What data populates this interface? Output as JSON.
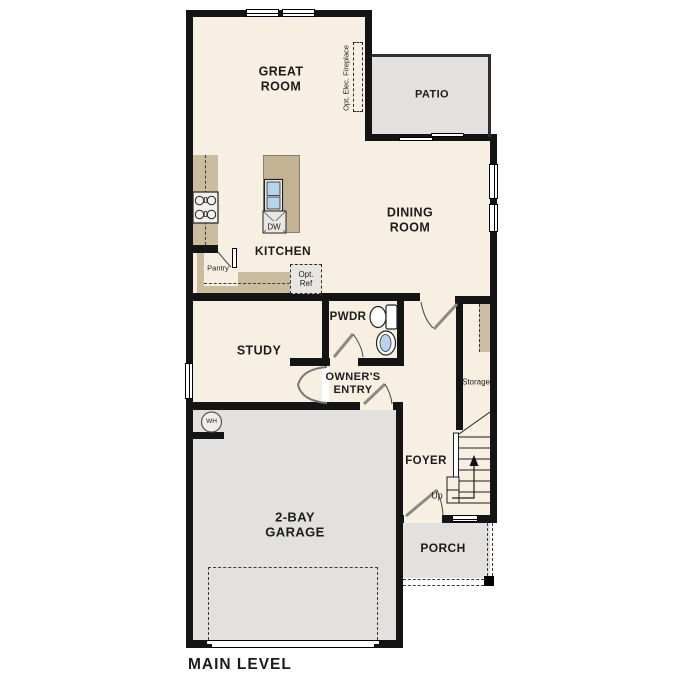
{
  "plan": {
    "title": "MAIN LEVEL"
  },
  "rooms": {
    "great_room": {
      "line1": "GREAT",
      "line2": "ROOM"
    },
    "patio": {
      "label": "PATIO"
    },
    "dining_room": {
      "line1": "DINING",
      "line2": "ROOM"
    },
    "kitchen": {
      "label": "KITCHEN"
    },
    "study": {
      "label": "STUDY"
    },
    "pwdr": {
      "label": "PWDR"
    },
    "owners_entry": {
      "line1": "OWNER'S",
      "line2": "ENTRY"
    },
    "foyer": {
      "label": "FOYER"
    },
    "storage": {
      "label": "Storage"
    },
    "garage": {
      "line1": "2-BAY",
      "line2": "GARAGE"
    },
    "porch": {
      "label": "PORCH"
    }
  },
  "annotations": {
    "fireplace": "Opt. Elec. Fireplace",
    "pantry": "Pantry",
    "opt_ref": {
      "line1": "Opt.",
      "line2": "Ref"
    },
    "dishwasher": "DW",
    "water_heater": "WH",
    "stairs_up": "Up"
  },
  "colors": {
    "floor": "#f7f0e2",
    "concrete": "#e2e1df",
    "counter": "#cbbc9e",
    "island": "#c3b394",
    "wall": "#141414",
    "fixture_blue": "#b8d3ec"
  }
}
